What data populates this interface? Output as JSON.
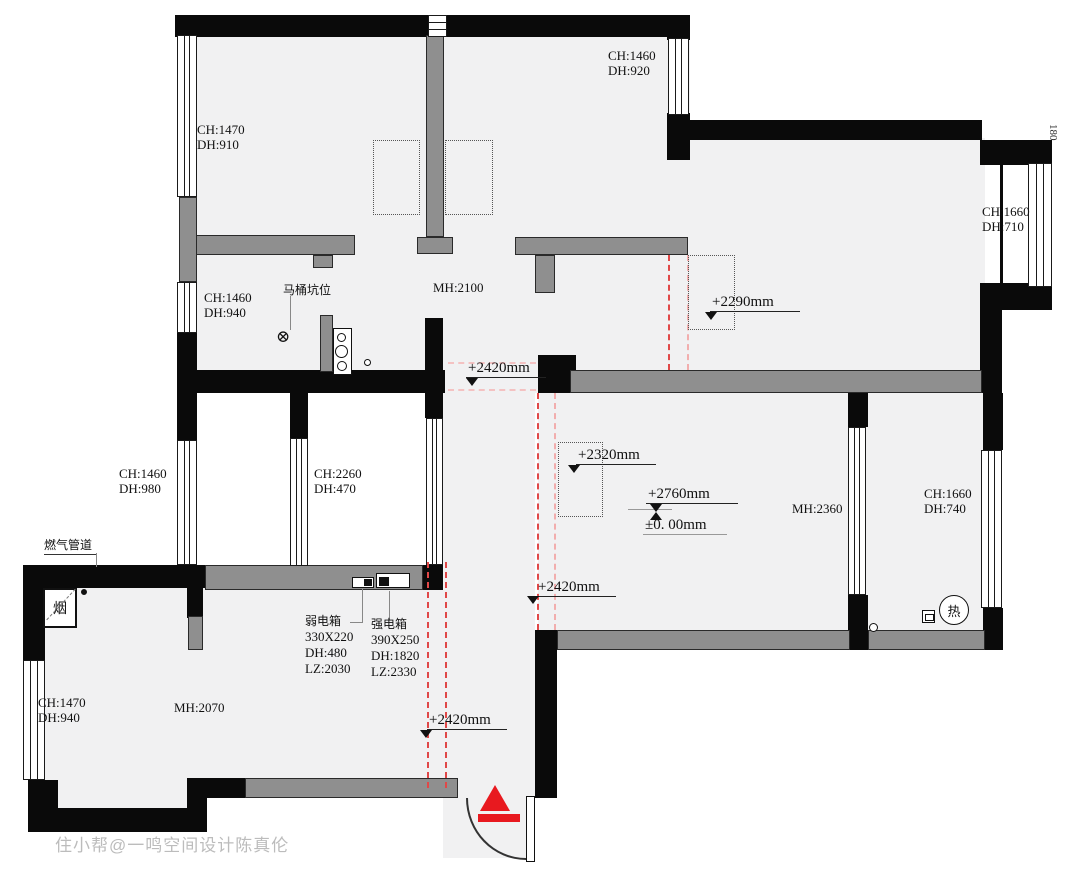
{
  "watermark": "住小帮@一鸣空间设计陈真伦",
  "edge_note": "180",
  "window_labels": [
    {
      "ch": "CH:1470",
      "dh": "DH:910"
    },
    {
      "ch": "CH:1460",
      "dh": "DH:920"
    },
    {
      "ch": "CH:1660",
      "dh": "DH:710"
    },
    {
      "ch": "CH:1460",
      "dh": "DH:940"
    },
    {
      "ch": "CH:1460",
      "dh": "DH:980"
    },
    {
      "ch": "CH:2260",
      "dh": "DH:470"
    },
    {
      "ch": "CH:1660",
      "dh": "DH:740"
    },
    {
      "ch": "CH:1470",
      "dh": "DH:940"
    }
  ],
  "height_labels": [
    {
      "text": "MH:2100"
    },
    {
      "text": "MH:2360"
    },
    {
      "text": "MH:2070"
    }
  ],
  "level_marks": {
    "right_room": "+2290mm",
    "hall": "+2420mm",
    "living": "+2320mm",
    "corridor": "+2420mm",
    "entry": "+2420mm",
    "datum_top": "+2760mm",
    "datum_bottom": "±0. 00mm"
  },
  "annotations": {
    "gas_pipe": "燃气管道",
    "flue": "烟",
    "toilet_pit": "马桶坑位",
    "water_heater": "热",
    "weak_box": {
      "title": "弱电箱",
      "size": "330X220",
      "dh": "DH:480",
      "lz": "LZ:2030"
    },
    "strong_box": {
      "title": "强电箱",
      "size": "390X250",
      "dh": "DH:1820",
      "lz": "LZ:2330"
    }
  },
  "colors": {
    "wall_black": "#0a0a0a",
    "wall_gray": "#8f8f8f",
    "floor": "#f1f1f2",
    "demolish_red": "#e04848",
    "entry_red": "#e8191f"
  }
}
